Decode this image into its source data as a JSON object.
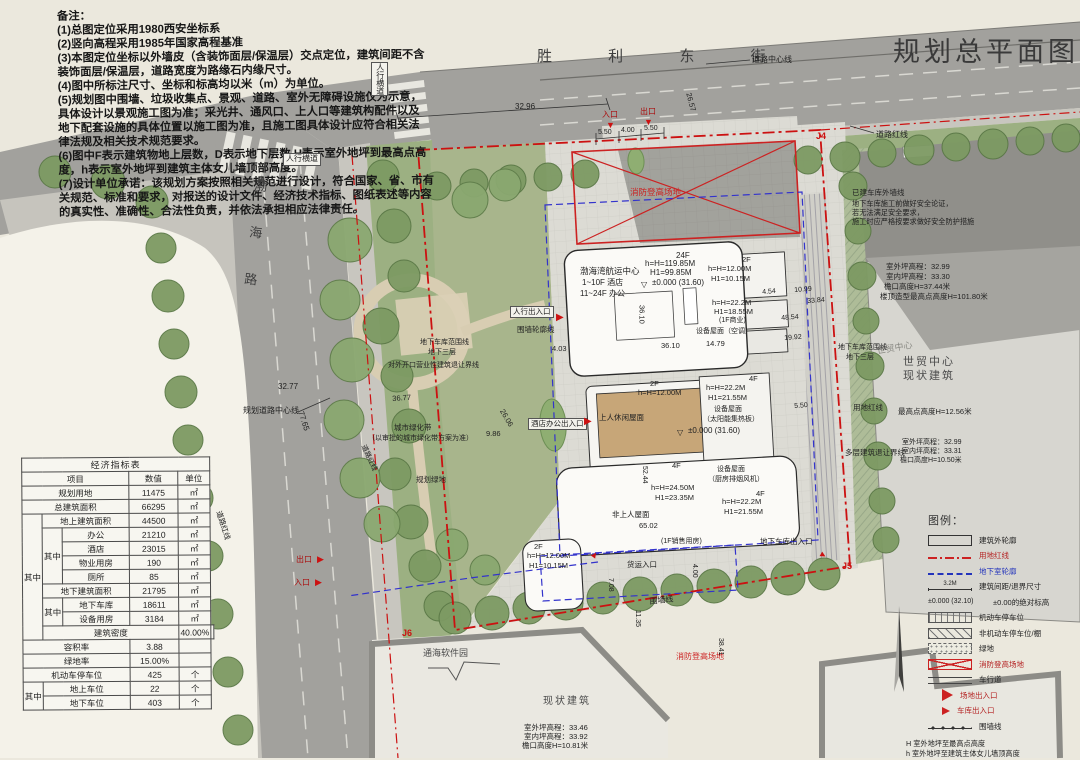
{
  "title": "规划总平面图",
  "streets": {
    "top": "胜 利 东 街",
    "left": "渤海路"
  },
  "notes": [
    "备注：",
    "(1)总图定位采用1980西安坐标系",
    "(2)竖向高程采用1985年国家高程基准",
    "(3)本图定位坐标以外墙皮（含装饰面层/保温层）交点定位，建筑间距不含",
    "装饰面层/保温层，道路宽度为路缘石内缘尺寸。",
    "(4)图中所标注尺寸、坐标和标高均以米（m）为单位。",
    "(5)规划图中围墙、垃圾收集点、景观、道路、室外无障碍设施仅为示意，",
    "具体设计以景观施工图为准；采光井、通风口、上人口等建筑构配件以及",
    "地下配套设施的具体位置以施工图为准，且施工图具体设计应符合相关法",
    "律法规及相关技术规范要求。",
    "(6)图中F表示建筑物地上层数，D表示地下层数,H表示室外地坪到最高点高",
    "度，h表示室外地坪到建筑主体女儿墙顶部高度。",
    "(7)设计单位承诺：该规划方案按照相关规范进行设计，符合国家、省、市有",
    "关规范、标准和要求，对报送的设计文件、经济技术指标、图纸表述等内容",
    "的真实性、准确性、合法性负责，并依法承担相应法律责任。"
  ],
  "econ": {
    "title": "经济指标表",
    "qz": "其中",
    "headers": {
      "item": "项目",
      "value": "数值",
      "unit": "单位"
    },
    "rows": [
      {
        "label": "规划用地",
        "value": "11475",
        "unit": "㎡"
      },
      {
        "label": "总建筑面积",
        "value": "66295",
        "unit": "㎡"
      },
      {
        "label": "地上建筑面积",
        "value": "44500",
        "unit": "㎡"
      },
      {
        "label": "办公",
        "value": "21210",
        "unit": "㎡"
      },
      {
        "label": "酒店",
        "value": "23015",
        "unit": "㎡"
      },
      {
        "label": "物业用房",
        "value": "190",
        "unit": "㎡"
      },
      {
        "label": "厕所",
        "value": "85",
        "unit": "㎡"
      },
      {
        "label": "地下建筑面积",
        "value": "21795",
        "unit": "㎡"
      },
      {
        "label": "地下车库",
        "value": "18611",
        "unit": "㎡"
      },
      {
        "label": "设备用房",
        "value": "3184",
        "unit": "㎡"
      },
      {
        "label": "建筑密度",
        "value": "40.00%",
        "unit": ""
      },
      {
        "label": "容积率",
        "value": "3.88",
        "unit": ""
      },
      {
        "label": "绿地率",
        "value": "15.00%",
        "unit": ""
      },
      {
        "label": "机动车停车位",
        "value": "425",
        "unit": "个"
      },
      {
        "label": "地上车位",
        "value": "22",
        "unit": "个"
      },
      {
        "label": "地下车位",
        "value": "403",
        "unit": "个"
      }
    ]
  },
  "legend": {
    "title": "图例：",
    "items": [
      {
        "label": "建筑外轮廓"
      },
      {
        "label": "用地红线"
      },
      {
        "label": "地下室轮廓"
      },
      {
        "label": "建筑间距/退界尺寸",
        "tag": "3.2M"
      },
      {
        "label": "±0.00的绝对标高",
        "tag": "±0.000 (32.10)"
      },
      {
        "label": "机动车停车位"
      },
      {
        "label": "非机动车停车位/棚"
      },
      {
        "label": "绿地"
      },
      {
        "label": "消防登高场地"
      },
      {
        "label": "车行道"
      },
      {
        "label": "场地出入口"
      },
      {
        "label": "车库出入口"
      },
      {
        "label": "围墙线"
      }
    ],
    "notes": [
      "H 室外地坪至最高点高度",
      "h 室外地坪至建筑主体女儿墙顶高度",
      "H1室外地坪至屋顶结构顶板高度"
    ]
  },
  "colors": {
    "red_line": "#cc1111",
    "blue_line": "#3333cc",
    "road": "#a2a19d",
    "green": "#9cb082",
    "plaza": "#dcdbd4"
  },
  "plan_labels": [
    {
      "t": "胜 利 东 街",
      "x": 537,
      "y": 48,
      "s": 15,
      "c": "#3f3f3f",
      "ls": 26,
      "name": "street-shengli-label"
    },
    {
      "t": "渤海路",
      "x": 252,
      "y": 178,
      "s": 13,
      "c": "#3f3f3f",
      "v": 1,
      "ls": 34,
      "r": 6,
      "name": "street-bohai-label"
    },
    {
      "t": "人行横道",
      "x": 371,
      "y": 62,
      "s": 8,
      "v": 1,
      "b": 1,
      "name": "crosswalk-label"
    },
    {
      "t": "人行横道",
      "x": 283,
      "y": 153,
      "s": 8,
      "b": 1,
      "name": "crosswalk-label"
    },
    {
      "t": "道路中心线",
      "x": 752,
      "y": 55,
      "s": 8
    },
    {
      "t": "道路红线",
      "x": 876,
      "y": 130,
      "s": 8
    },
    {
      "t": "J4",
      "x": 816,
      "y": 131,
      "s": 9,
      "c": "#cc1111",
      "w": 700,
      "name": "marker-j4"
    },
    {
      "t": "J5",
      "x": 842,
      "y": 561,
      "s": 9,
      "c": "#cc1111",
      "w": 700,
      "name": "marker-j5"
    },
    {
      "t": "J6",
      "x": 402,
      "y": 628,
      "s": 9,
      "c": "#cc1111",
      "w": 700,
      "name": "marker-j6"
    },
    {
      "t": "已建车库外墙线",
      "x": 852,
      "y": 189,
      "s": 7.5
    },
    {
      "t": "地下车库施工前做好安全论证，",
      "x": 852,
      "y": 200,
      "s": 7.2
    },
    {
      "t": "若无法满足安全要求，",
      "x": 852,
      "y": 209,
      "s": 7.2
    },
    {
      "t": "施工时应严格按要求做好安全防护措施",
      "x": 852,
      "y": 218,
      "s": 7.2
    },
    {
      "t": "室外坪高程：32.99",
      "x": 886,
      "y": 263,
      "s": 7.5
    },
    {
      "t": "室内坪高程：33.30",
      "x": 886,
      "y": 273,
      "s": 7.5
    },
    {
      "t": "檐口高度H=37.44米",
      "x": 884,
      "y": 283,
      "s": 7.5
    },
    {
      "t": "楼顶造型最高点高度H=101.80米",
      "x": 880,
      "y": 293,
      "s": 7.5
    },
    {
      "t": "世贸中心",
      "x": 876,
      "y": 346,
      "s": 9,
      "c": "#8a8a84",
      "r": -10
    },
    {
      "t": "世贸中心",
      "x": 903,
      "y": 356,
      "s": 11,
      "c": "#4a4a4a",
      "ls": 2,
      "name": "wtc-label"
    },
    {
      "t": "现状建筑",
      "x": 903,
      "y": 370,
      "s": 11,
      "c": "#4a4a4a",
      "ls": 2
    },
    {
      "t": "地下车库范围线",
      "x": 838,
      "y": 344,
      "s": 7
    },
    {
      "t": "地下三层",
      "x": 846,
      "y": 354,
      "s": 7
    },
    {
      "t": "用地红线",
      "x": 853,
      "y": 404,
      "s": 7.5
    },
    {
      "t": "最高点高度H=12.56米",
      "x": 898,
      "y": 408,
      "s": 7.5
    },
    {
      "t": "多层建筑退让界线",
      "x": 845,
      "y": 449,
      "s": 7.5
    },
    {
      "t": "室外坪高程：32.99",
      "x": 902,
      "y": 439,
      "s": 7
    },
    {
      "t": "室内坪高程：33.31",
      "x": 902,
      "y": 448,
      "s": 7
    },
    {
      "t": "檐口高度H=10.50米",
      "x": 900,
      "y": 457,
      "s": 7
    },
    {
      "t": "地下车库范围线",
      "x": 420,
      "y": 339,
      "s": 7
    },
    {
      "t": "地下三层",
      "x": 428,
      "y": 349,
      "s": 7
    },
    {
      "t": "对外开口营业性建筑退让界线",
      "x": 388,
      "y": 362,
      "s": 7
    },
    {
      "t": "城市绿化带",
      "x": 394,
      "y": 424,
      "s": 7.5
    },
    {
      "t": "（以审批的城市绿化带方案为准）",
      "x": 368,
      "y": 435,
      "s": 7
    },
    {
      "t": "规划绿地",
      "x": 416,
      "y": 476,
      "s": 7.5
    },
    {
      "t": "道路红线",
      "x": 366,
      "y": 444,
      "s": 7,
      "r": 65
    },
    {
      "t": "规划道路中心线",
      "x": 243,
      "y": 406,
      "s": 8
    },
    {
      "t": "道路红线",
      "x": 222,
      "y": 510,
      "s": 7.5,
      "r": 72
    },
    {
      "t": "32.77",
      "x": 278,
      "y": 382,
      "s": 8
    },
    {
      "t": "77.65",
      "x": 305,
      "y": 410,
      "s": 8,
      "r": 72
    },
    {
      "t": "36.77",
      "x": 392,
      "y": 395,
      "s": 7.5,
      "r": -4
    },
    {
      "t": "26.06",
      "x": 505,
      "y": 408,
      "s": 7.5,
      "r": 60
    },
    {
      "t": "9.86",
      "x": 486,
      "y": 430,
      "s": 7.5
    },
    {
      "t": "出口",
      "x": 296,
      "y": 555,
      "s": 8,
      "c": "#aa1111"
    },
    {
      "t": "入口",
      "x": 294,
      "y": 578,
      "s": 8,
      "c": "#aa1111"
    },
    {
      "t": "▶",
      "x": 317,
      "y": 554,
      "s": 9,
      "c": "#cc1111",
      "name": "exit-arrow-icon"
    },
    {
      "t": "▶",
      "x": 315,
      "y": 577,
      "s": 9,
      "c": "#cc1111",
      "name": "entry-arrow-icon"
    },
    {
      "t": "人行出入口",
      "x": 510,
      "y": 306,
      "s": 7.5,
      "b": 1
    },
    {
      "t": "围墙轮廓线",
      "x": 517,
      "y": 326,
      "s": 7.5
    },
    {
      "t": "▶",
      "x": 556,
      "y": 312,
      "s": 10,
      "c": "#cc1111",
      "name": "pedestrian-gate-icon"
    },
    {
      "t": "酒店办公出入口",
      "x": 528,
      "y": 418,
      "s": 7.5,
      "b": 1
    },
    {
      "t": "▶",
      "x": 584,
      "y": 416,
      "s": 10,
      "c": "#cc1111",
      "name": "hotel-office-gate-icon"
    },
    {
      "t": "32.96",
      "x": 515,
      "y": 102,
      "s": 8
    },
    {
      "t": "入口",
      "x": 602,
      "y": 110,
      "s": 8,
      "c": "#aa1111"
    },
    {
      "t": "出口",
      "x": 640,
      "y": 107,
      "s": 8,
      "c": "#aa1111"
    },
    {
      "t": "▼",
      "x": 606,
      "y": 120,
      "s": 9,
      "c": "#cc1111",
      "name": "vehicle-entry-icon"
    },
    {
      "t": "▼",
      "x": 644,
      "y": 117,
      "s": 9,
      "c": "#cc1111",
      "name": "vehicle-exit-icon"
    },
    {
      "t": "5.50",
      "x": 598,
      "y": 129,
      "s": 7
    },
    {
      "t": "4.00",
      "x": 621,
      "y": 127,
      "s": 7
    },
    {
      "t": "5.50",
      "x": 644,
      "y": 125,
      "s": 7
    },
    {
      "t": "26.57",
      "x": 692,
      "y": 92,
      "s": 7.5,
      "r": 75
    },
    {
      "t": "消防登高场地",
      "x": 630,
      "y": 188,
      "s": 8.5,
      "c": "#cc2222",
      "name": "fire-lane-label"
    },
    {
      "t": "消防登高场地",
      "x": 676,
      "y": 652,
      "s": 8,
      "c": "#cc2222",
      "name": "fire-lane-label"
    },
    {
      "t": "24F",
      "x": 676,
      "y": 251,
      "s": 8
    },
    {
      "t": "h=H=119.85M",
      "x": 645,
      "y": 259,
      "s": 8
    },
    {
      "t": "H1=99.85M",
      "x": 650,
      "y": 268,
      "s": 8
    },
    {
      "t": "±0.000 (31.60)",
      "x": 652,
      "y": 278,
      "s": 8
    },
    {
      "t": "▽",
      "x": 641,
      "y": 280,
      "s": 8,
      "name": "elevation-mark-icon"
    },
    {
      "t": "渤海湾航运中心",
      "x": 580,
      "y": 267,
      "s": 8.5,
      "name": "tower-name-label"
    },
    {
      "t": "1~10F 酒店",
      "x": 582,
      "y": 278,
      "s": 8
    },
    {
      "t": "11~24F 办公",
      "x": 580,
      "y": 289,
      "s": 8
    },
    {
      "t": "36.10",
      "x": 637,
      "y": 305,
      "s": 7.5,
      "v": 1
    },
    {
      "t": "36.10",
      "x": 661,
      "y": 342,
      "s": 7.5
    },
    {
      "t": "4.03",
      "x": 552,
      "y": 345,
      "s": 7.5
    },
    {
      "t": "2F",
      "x": 742,
      "y": 256,
      "s": 7.5
    },
    {
      "t": "h=H=12.00M",
      "x": 708,
      "y": 265,
      "s": 7.5
    },
    {
      "t": "H1=10.15M",
      "x": 711,
      "y": 275,
      "s": 7.5
    },
    {
      "t": "h=H=22.2M",
      "x": 712,
      "y": 299,
      "s": 7.5
    },
    {
      "t": "H1=18.55M",
      "x": 714,
      "y": 308,
      "s": 7.5
    },
    {
      "t": "(1F商业)",
      "x": 719,
      "y": 317,
      "s": 7
    },
    {
      "t": "设备屋面（空调）",
      "x": 696,
      "y": 328,
      "s": 7
    },
    {
      "t": "14.79",
      "x": 706,
      "y": 340,
      "s": 7.5
    },
    {
      "t": "4.54",
      "x": 762,
      "y": 289,
      "s": 7,
      "r": -4
    },
    {
      "t": "10.99",
      "x": 794,
      "y": 287,
      "s": 7,
      "r": -4
    },
    {
      "t": "33.84",
      "x": 807,
      "y": 298,
      "s": 7,
      "r": -4
    },
    {
      "t": "48.54",
      "x": 781,
      "y": 315,
      "s": 7,
      "r": -4
    },
    {
      "t": "19.92",
      "x": 784,
      "y": 335,
      "s": 7,
      "r": -4
    },
    {
      "t": "5.50",
      "x": 794,
      "y": 403,
      "s": 7,
      "r": -4
    },
    {
      "t": "2F",
      "x": 650,
      "y": 380,
      "s": 7.5
    },
    {
      "t": "h=H=12.00M",
      "x": 638,
      "y": 389,
      "s": 7.5
    },
    {
      "t": "上人休闲屋面",
      "x": 599,
      "y": 414,
      "s": 7.5
    },
    {
      "t": "4F",
      "x": 749,
      "y": 375,
      "s": 7.5
    },
    {
      "t": "h=H=22.2M",
      "x": 706,
      "y": 384,
      "s": 7.5
    },
    {
      "t": "H1=21.55M",
      "x": 708,
      "y": 394,
      "s": 7.5
    },
    {
      "t": "设备屋面",
      "x": 714,
      "y": 406,
      "s": 7
    },
    {
      "t": "（太阳能集热板）",
      "x": 703,
      "y": 416,
      "s": 7
    },
    {
      "t": "±0.000 (31.60)",
      "x": 688,
      "y": 426,
      "s": 8
    },
    {
      "t": "▽",
      "x": 677,
      "y": 428,
      "s": 8,
      "name": "elevation-mark-icon"
    },
    {
      "t": "设备屋面",
      "x": 717,
      "y": 466,
      "s": 7
    },
    {
      "t": "（厨房排烟风机）",
      "x": 708,
      "y": 476,
      "s": 7
    },
    {
      "t": "4F",
      "x": 756,
      "y": 490,
      "s": 7.5
    },
    {
      "t": "h=H=22.2M",
      "x": 722,
      "y": 498,
      "s": 7.5
    },
    {
      "t": "H1=21.55M",
      "x": 724,
      "y": 508,
      "s": 7.5
    },
    {
      "t": "4F",
      "x": 672,
      "y": 462,
      "s": 7.5
    },
    {
      "t": "h=H=24.50M",
      "x": 651,
      "y": 484,
      "s": 7.5
    },
    {
      "t": "H1=23.35M",
      "x": 655,
      "y": 494,
      "s": 7.5
    },
    {
      "t": "非上人屋面",
      "x": 612,
      "y": 511,
      "s": 7.5
    },
    {
      "t": "65.02",
      "x": 639,
      "y": 522,
      "s": 7.5
    },
    {
      "t": "52.44",
      "x": 640,
      "y": 466,
      "s": 7,
      "v": 1
    },
    {
      "t": "(1F销售用房)",
      "x": 661,
      "y": 538,
      "s": 7
    },
    {
      "t": "2F",
      "x": 534,
      "y": 543,
      "s": 7.5
    },
    {
      "t": "h=H=12.00M",
      "x": 527,
      "y": 552,
      "s": 7.5
    },
    {
      "t": "H1=10.15M",
      "x": 529,
      "y": 562,
      "s": 7.5
    },
    {
      "t": "货运入口",
      "x": 627,
      "y": 561,
      "s": 7.5
    },
    {
      "t": "▲",
      "x": 594,
      "y": 548,
      "s": 9,
      "c": "#cc1111",
      "r": 35,
      "name": "freight-entry-icon"
    },
    {
      "t": "地下车库出入口",
      "x": 760,
      "y": 538,
      "s": 7.5
    },
    {
      "t": "▲",
      "x": 830,
      "y": 554,
      "s": 9,
      "c": "#cc1111",
      "r": 120,
      "name": "garage-entry-icon"
    },
    {
      "t": "围墙线",
      "x": 649,
      "y": 597,
      "s": 8,
      "r": -6
    },
    {
      "t": "7.08",
      "x": 606,
      "y": 578,
      "s": 7,
      "v": 1
    },
    {
      "t": "11.35",
      "x": 633,
      "y": 610,
      "s": 7,
      "v": 1
    },
    {
      "t": "4.00",
      "x": 690,
      "y": 564,
      "s": 7,
      "v": 1
    },
    {
      "t": "38.41",
      "x": 716,
      "y": 638,
      "s": 7,
      "v": 1
    },
    {
      "t": "通海软件园",
      "x": 423,
      "y": 648,
      "s": 9,
      "c": "#4a4a4a",
      "name": "software-park-label"
    },
    {
      "t": "现状建筑",
      "x": 543,
      "y": 696,
      "s": 10,
      "c": "#4a4a4a",
      "ls": 2,
      "name": "existing-building-label"
    },
    {
      "t": "室外坪高程：33.46",
      "x": 524,
      "y": 724,
      "s": 7.5
    },
    {
      "t": "室内坪高程：33.92",
      "x": 524,
      "y": 733,
      "s": 7.5
    },
    {
      "t": "檐口高度H=10.81米",
      "x": 522,
      "y": 742,
      "s": 7.5
    }
  ]
}
